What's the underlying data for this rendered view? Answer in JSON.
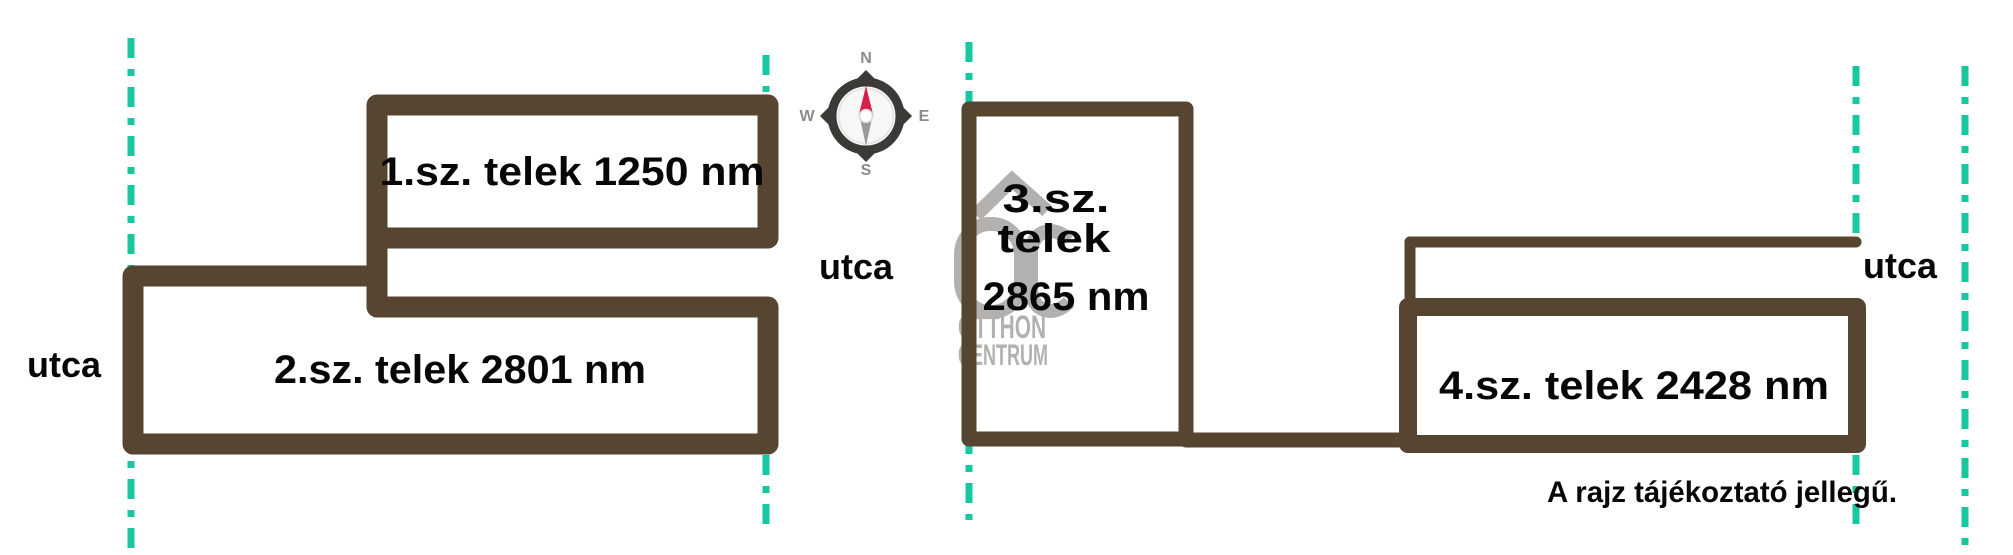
{
  "diagram": {
    "disclaimer": "A rajz tájékoztató jellegű.",
    "street_label_left": "utca",
    "street_label_middle": "utca",
    "street_label_right": "utca"
  },
  "plots": [
    {
      "label": "1.sz. telek 1250 nm",
      "area_nm": "1250"
    },
    {
      "label": "2.sz. telek 2801 nm",
      "area_nm": "2801"
    },
    {
      "label_line1": "3.sz.",
      "label_line2": "telek",
      "label_line3": "2865 nm",
      "area_nm": "2865"
    },
    {
      "label": "4.sz. telek 2428 nm",
      "area_nm": "2428"
    }
  ],
  "compass": {
    "n": "N",
    "e": "E",
    "s": "S",
    "w": "W"
  },
  "watermark": {
    "brand_line1": "OTTHON",
    "brand_line2": "CENTRUM"
  },
  "colors": {
    "plot_outline": "#564531",
    "street_dash": "#15C8A0",
    "watermark_gray": "#B3B1AF",
    "compass_ring": "#3B3A36",
    "compass_inner": "#F7F7F5",
    "compass_north_needle": "#D5204C",
    "compass_south_needle": "#9A9A9A",
    "compass_label": "#8B8B8B",
    "label_text": "#070707"
  }
}
